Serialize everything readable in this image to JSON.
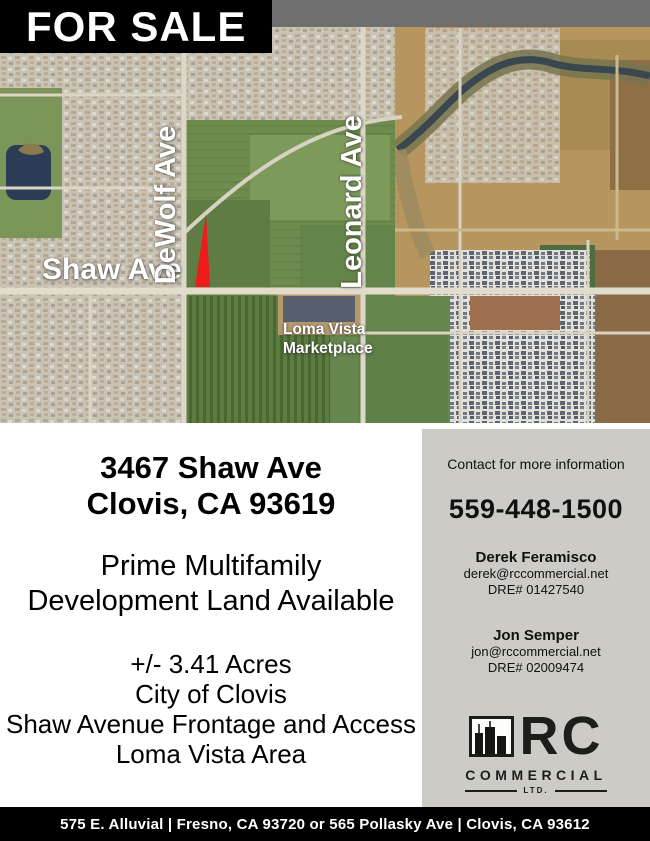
{
  "banner": {
    "label": "FOR SALE"
  },
  "map": {
    "labels": {
      "vertical_street_1": "DeWolf Ave",
      "vertical_street_2": "Leonard Ave",
      "horizontal_street": "Shaw Ave",
      "poi_line1": "Loma Vista",
      "poi_line2": "Marketplace"
    }
  },
  "property": {
    "address_line1": "3467 Shaw Ave",
    "address_line2": "Clovis, CA 93619",
    "headline_line1": "Prime Multifamily",
    "headline_line2": "Development Land Available",
    "details": [
      "+/- 3.41 Acres",
      "City of Clovis",
      "Shaw Avenue Frontage and Access",
      "Loma Vista Area"
    ]
  },
  "contact": {
    "heading": "Contact for more information",
    "phone": "559-448-1500",
    "agents": [
      {
        "name": "Derek Feramisco",
        "email": "derek@rccommercial.net",
        "dre": "DRE# 01427540"
      },
      {
        "name": "Jon Semper",
        "email": "jon@rccommercial.net",
        "dre": "DRE# 02009474"
      }
    ],
    "logo": {
      "primary": "RC",
      "secondary": "COMMERCIAL",
      "tertiary": "LTD."
    }
  },
  "footer": {
    "address_bar": "575 E. Alluvial | Fresno, CA 93720 or 565 Pollasky Ave | Clovis, CA 93612"
  },
  "colors": {
    "accent_red": "#ee1b1b",
    "panel_gray": "#cccbc5",
    "strip_gray": "#6f6f6f",
    "banner_black": "#000000"
  }
}
